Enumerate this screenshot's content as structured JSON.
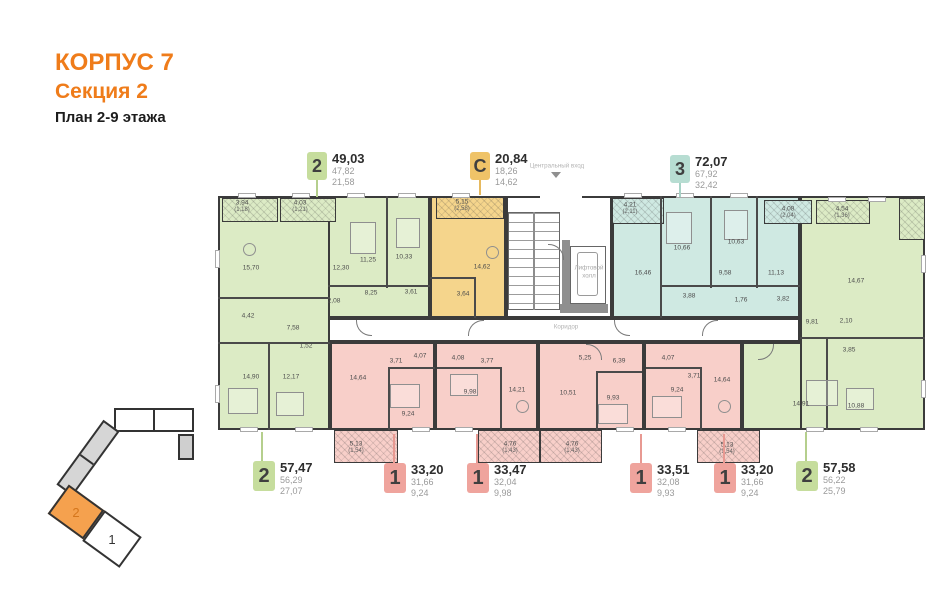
{
  "header": {
    "building": "КОРПУС 7",
    "section": "Секция 2",
    "plan": "План 2-9 этажа"
  },
  "labels": {
    "central_entrance": "Центральный вход",
    "elevator_hall_line1": "Лифтовой",
    "elevator_hall_line2": "холл",
    "corridor": "Коридор"
  },
  "colors": {
    "accent_orange": "#EF7C1A",
    "wall": "#3B3B3B",
    "green_fill": "#DCEBC5",
    "yellow_fill": "#F5D58C",
    "teal_fill": "#CFE9E2",
    "pink_fill": "#F8CFC9",
    "green_badge": "#C6DD9D",
    "yellow_badge": "#EFC368",
    "teal_badge": "#B7DDD2",
    "pink_badge": "#EFA49D",
    "locator_highlight": "#F5A14E"
  },
  "locator": {
    "highlighted_section": "2",
    "other_section": "1"
  },
  "callouts_top": [
    {
      "type": "2",
      "total": "49,03",
      "living": "47,82",
      "kitchen": "21,58"
    },
    {
      "type": "C",
      "total": "20,84",
      "living": "18,26",
      "kitchen": "14,62"
    },
    {
      "type": "3",
      "total": "72,07",
      "living": "67,92",
      "kitchen": "32,42"
    }
  ],
  "callouts_bottom": [
    {
      "type": "2",
      "total": "57,47",
      "living": "56,29",
      "kitchen": "27,07"
    },
    {
      "type": "1",
      "total": "33,20",
      "living": "31,66",
      "kitchen": "9,24"
    },
    {
      "type": "1",
      "total": "33,47",
      "living": "32,04",
      "kitchen": "9,98"
    },
    {
      "type": "1",
      "total": "33,51",
      "living": "32,08",
      "kitchen": "9,93"
    },
    {
      "type": "1",
      "total": "33,20",
      "living": "31,66",
      "kitchen": "9,24"
    },
    {
      "type": "2",
      "total": "57,58",
      "living": "56,22",
      "kitchen": "25,79"
    }
  ],
  "rooms": [
    {
      "name": "g1-balcony",
      "a": "3,94",
      "b": "(1,18)"
    },
    {
      "name": "g2-balcony",
      "a": "4,03",
      "b": "(1,21)"
    },
    {
      "name": "studio-balcony",
      "a": "5,15",
      "b": "(2,58)"
    },
    {
      "name": "t3-balcony-1",
      "a": "4,21",
      "b": "(2,11)"
    },
    {
      "name": "t3-balcony-2",
      "a": "4,08",
      "b": "(2,04)"
    },
    {
      "name": "gr-balcony",
      "a": "4,54",
      "b": "(1,36)"
    },
    {
      "name": "g1-living",
      "a": "15,70"
    },
    {
      "name": "g1-bath",
      "a": "4,42"
    },
    {
      "name": "g1-hall",
      "a": "7,58"
    },
    {
      "name": "g1-storage",
      "a": "1,52"
    },
    {
      "name": "g1-bedroom-1",
      "a": "14,90"
    },
    {
      "name": "g1-bedroom-2",
      "a": "12,17"
    },
    {
      "name": "g2-room-1",
      "a": "12,30"
    },
    {
      "name": "g2-room-2",
      "a": "11,25"
    },
    {
      "name": "g2-hall",
      "a": "8,25"
    },
    {
      "name": "g2-corridor",
      "a": "2,08"
    },
    {
      "name": "g2-room-3",
      "a": "10,33"
    },
    {
      "name": "g2-bath",
      "a": "3,61"
    },
    {
      "name": "studio-room",
      "a": "14,62"
    },
    {
      "name": "studio-bath",
      "a": "3,64"
    },
    {
      "name": "t3-living",
      "a": "16,46"
    },
    {
      "name": "t3-room-1",
      "a": "10,66"
    },
    {
      "name": "t3-room-2",
      "a": "10,63"
    },
    {
      "name": "t3-hall",
      "a": "9,58"
    },
    {
      "name": "t3-bath",
      "a": "3,88"
    },
    {
      "name": "t3-wc",
      "a": "1,76"
    },
    {
      "name": "t3-room-3",
      "a": "11,13"
    },
    {
      "name": "t3-bath-2",
      "a": "3,82"
    },
    {
      "name": "gr-living",
      "a": "14,67"
    },
    {
      "name": "gr-hall",
      "a": "9,81"
    },
    {
      "name": "gr-wc",
      "a": "2,10"
    },
    {
      "name": "gr-bath",
      "a": "3,85"
    },
    {
      "name": "gr-bedroom-1",
      "a": "14,91"
    },
    {
      "name": "gr-bedroom-2",
      "a": "10,88"
    },
    {
      "name": "p1-kitchen-living",
      "a": "14,64"
    },
    {
      "name": "p1-hall",
      "a": "3,71"
    },
    {
      "name": "p1-bath",
      "a": "4,07"
    },
    {
      "name": "p1-bedroom",
      "a": "9,24"
    },
    {
      "name": "p1-balcony",
      "a": "5,13",
      "b": "(1,54)"
    },
    {
      "name": "p2-bath",
      "a": "4,08"
    },
    {
      "name": "p2-hall",
      "a": "3,77"
    },
    {
      "name": "p2-bedroom",
      "a": "9,98"
    },
    {
      "name": "p2-kitchen-living",
      "a": "14,21"
    },
    {
      "name": "p2-balcony",
      "a": "4,76",
      "b": "(1,43)"
    },
    {
      "name": "p3-hall",
      "a": "5,25"
    },
    {
      "name": "p3-corridor",
      "a": "6,39"
    },
    {
      "name": "p3-kitchen-living",
      "a": "10,51"
    },
    {
      "name": "p3-bedroom",
      "a": "9,93"
    },
    {
      "name": "p3-balcony",
      "a": "4,76",
      "b": "(1,43)"
    },
    {
      "name": "p4-bath",
      "a": "4,07"
    },
    {
      "name": "p4-hall",
      "a": "3,71"
    },
    {
      "name": "p4-bedroom",
      "a": "9,24"
    },
    {
      "name": "p4-kitchen-living",
      "a": "14,64"
    },
    {
      "name": "p4-balcony",
      "a": "5,13",
      "b": "(1,54)"
    }
  ]
}
